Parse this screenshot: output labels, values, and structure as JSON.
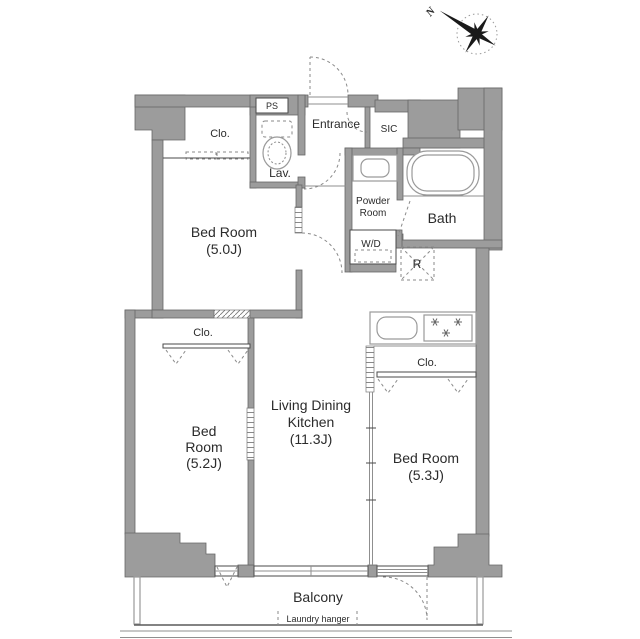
{
  "compass": {
    "north": "N"
  },
  "rooms": {
    "closet_top": "Clo.",
    "ps": "PS",
    "lavatory": "Lav.",
    "entrance": "Entrance",
    "sic": "SIC",
    "powder_line1": "Powder",
    "powder_line2": "Room",
    "bath": "Bath",
    "wd": "W/D",
    "refrigerator": "R",
    "bedroom1_line1": "Bed Room",
    "bedroom1_line2": "(5.0J)",
    "closet_mid": "Clo.",
    "bedroom2_line1": "Bed",
    "bedroom2_line2": "Room",
    "bedroom2_line3": "(5.2J)",
    "ldk_line1": "Living Dining",
    "ldk_line2": "Kitchen",
    "ldk_line3": "(11.3J)",
    "closet_kitchen": "Clo.",
    "bedroom3_line1": "Bed Room",
    "bedroom3_line2": "(5.3J)",
    "balcony": "Balcony",
    "laundry_hanger": "Laundry hanger"
  },
  "colors": {
    "wall": "#9c9c9c",
    "line": "#4a4a4a",
    "text": "#2b2b2b"
  }
}
